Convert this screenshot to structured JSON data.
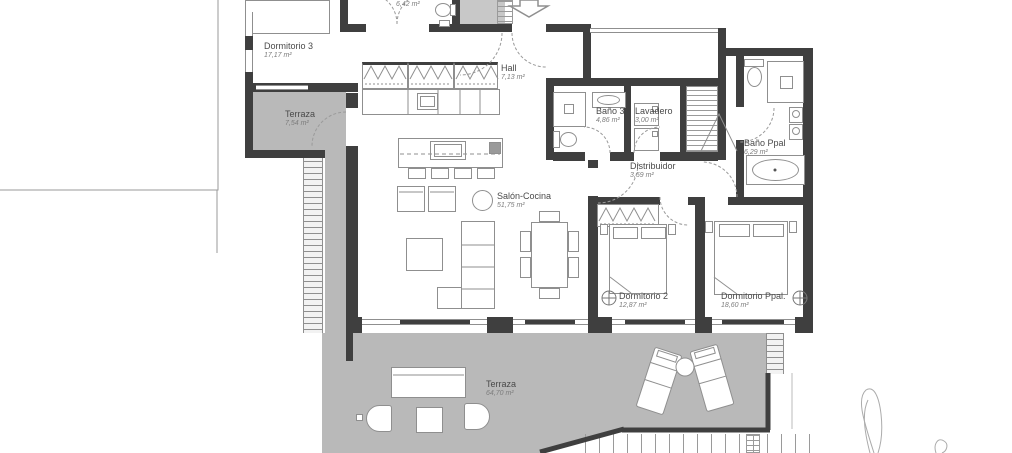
{
  "rooms": {
    "dormitorio3": {
      "name": "Dormitorio 3",
      "area": "17,17 m²"
    },
    "terraza_norte": {
      "name": "Terraza",
      "area": "7,54 m²"
    },
    "banyo2": {
      "area": "6,42 m²"
    },
    "hall": {
      "name": "Hall",
      "area": "7,13 m²"
    },
    "banyo3": {
      "name": "Baño 3",
      "area": "4,86 m²"
    },
    "lavadero": {
      "name": "Lavadero",
      "area": "3,00 m²"
    },
    "distribuidor": {
      "name": "Distribuidor",
      "area": "3,59 m²"
    },
    "banyo_ppal": {
      "name": "Baño Ppal",
      "area": "6,29 m²"
    },
    "salon_cocina": {
      "name": "Salón-Cocina",
      "area": "51,75 m²"
    },
    "dormitorio2": {
      "name": "Dormitorio 2",
      "area": "12,87 m²"
    },
    "dormitorio_ppal": {
      "name": "Dormitorio Ppal.",
      "area": "18,60 m²"
    },
    "terraza_sur": {
      "name": "Terraza",
      "area": "64,70 m²"
    }
  },
  "colors": {
    "wall": "#3f3f3f",
    "terrace": "#b9b9b9",
    "entry_zone": "#c8c8c8",
    "linework": "#8f8f8f"
  }
}
